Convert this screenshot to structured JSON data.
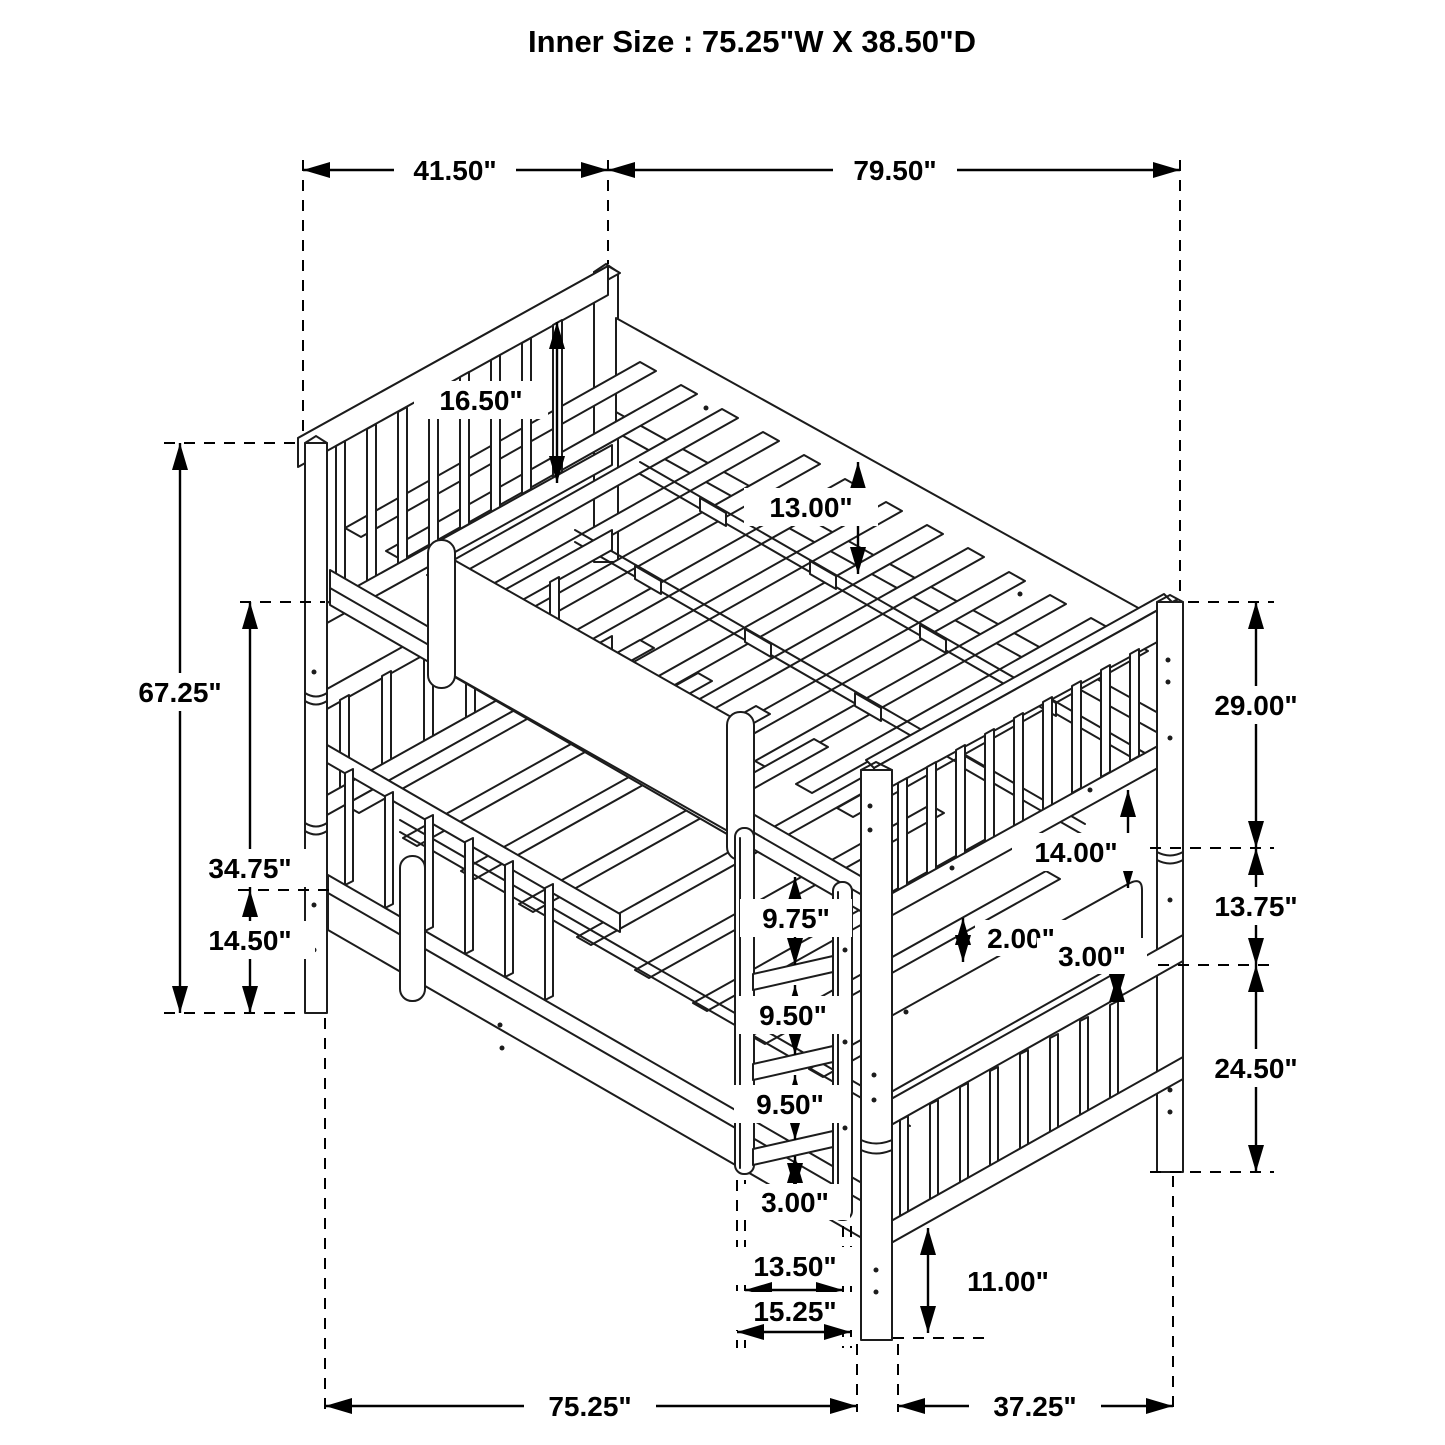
{
  "title": "Inner Size : 75.25\"W X  38.50\"D",
  "colors": {
    "line": "#1c1c1c",
    "dimension": "#000000",
    "background": "#ffffff"
  },
  "diagram": {
    "type": "isometric-bunk-bed-dimension-drawing",
    "dims": {
      "top_depth": "41.50\"",
      "top_width": "79.50\"",
      "overall_height": "67.25\"",
      "upper_rail_height": "34.75\"",
      "lower_rail_height": "14.50\"",
      "headboard_rail": "16.50\"",
      "side_rail_height": "13.00\"",
      "right_upper": "29.00\"",
      "right_middle": "13.75\"",
      "right_lower": "24.50\"",
      "footboard_gap": "14.00\"",
      "slat_thickness": "2.00\"",
      "foot_rail_thickness": "3.00\"",
      "ladder_step_1": "9.75\"",
      "ladder_step_2": "9.50\"",
      "ladder_step_3": "9.50\"",
      "ladder_step_4": "3.00\"",
      "ladder_inner_width": "13.50\"",
      "ladder_outer_width": "15.25\"",
      "leg_height": "11.00\"",
      "bottom_width": "75.25\"",
      "bottom_depth": "37.25\""
    }
  }
}
